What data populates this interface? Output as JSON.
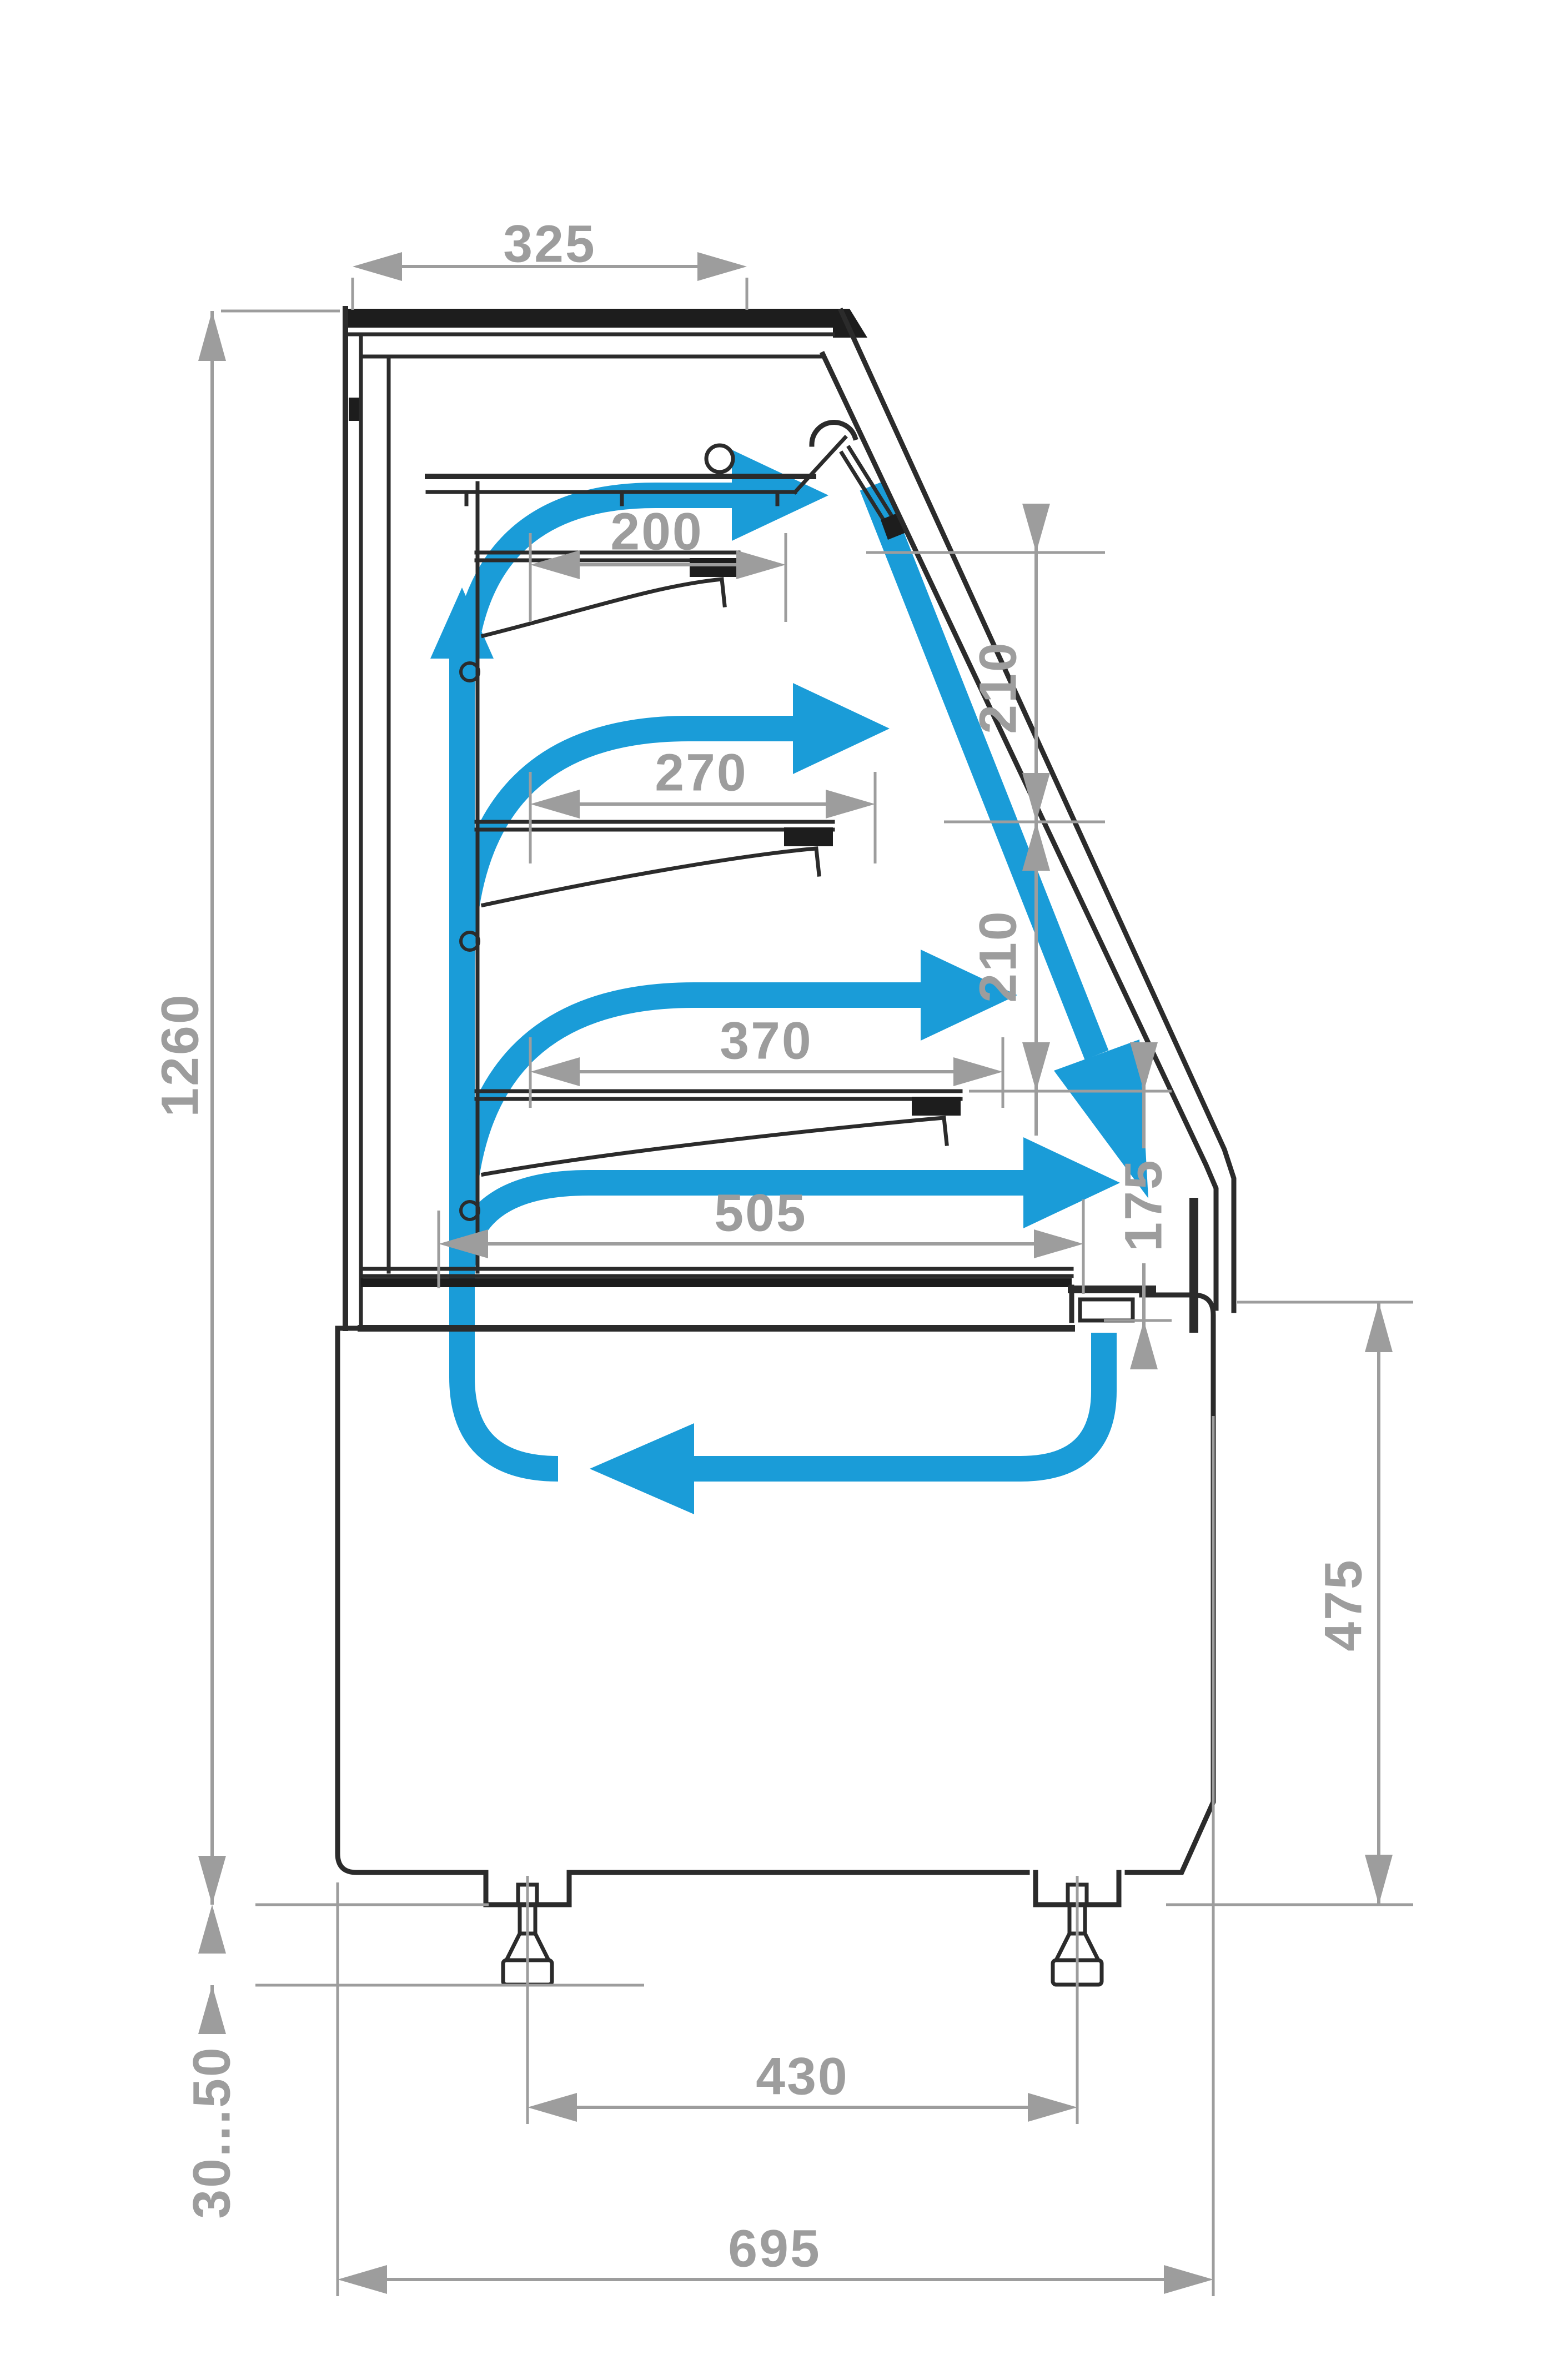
{
  "meta": {
    "title": "Refrigerated display case side section with airflow circulation and dimensions",
    "units": "mm"
  },
  "dimensions": {
    "top_depth": "325",
    "shelf_top_depth": "200",
    "shelf_middle_depth": "270",
    "shelf_lower_depth": "370",
    "well_depth": "505",
    "tier_gap_top": "210",
    "tier_gap_middle": "210",
    "front_opening": "175",
    "overall_height": "1260",
    "base_height": "475",
    "leg_spacing": "430",
    "overall_depth": "695",
    "leg_height_range": "30...50"
  },
  "colors": {
    "airflow_blue": "#1a9cd8",
    "outline_black": "#2b2b2b",
    "dimension_gray": "#9d9d9d"
  },
  "icons": [
    {
      "name": "airflow-arrow",
      "meaning": "cold air circulation path"
    },
    {
      "name": "lamp",
      "meaning": "canopy light fixture"
    },
    {
      "name": "adjustable-foot",
      "meaning": "height adjustable leg 30...50 mm"
    }
  ]
}
